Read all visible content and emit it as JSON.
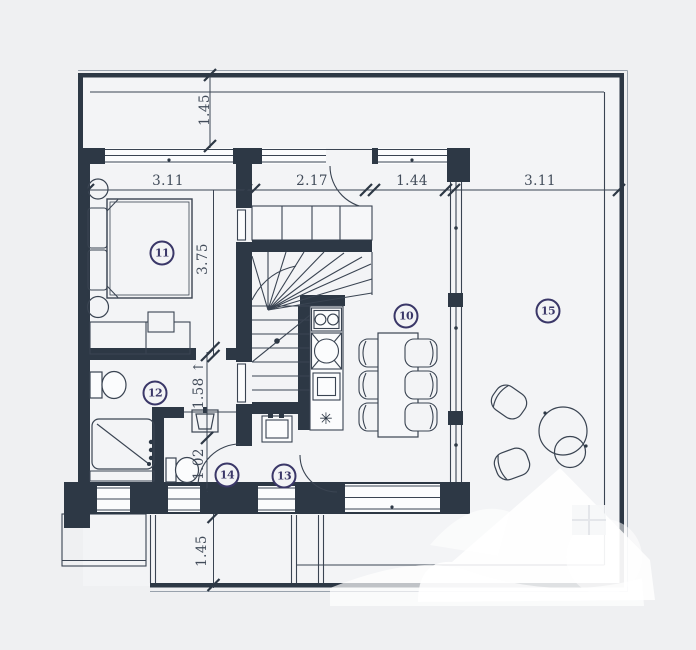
{
  "plan_title": "apartment-floor-plan",
  "colors": {
    "wall": "#2d3845",
    "thin_line": "#3a4452",
    "dim_text": "#414b59",
    "badge": "#3a3768",
    "background": "#eff0f2",
    "floor": "#f3f4f6",
    "watermark": "#ffffff"
  },
  "rooms": [
    {
      "label": "11"
    },
    {
      "label": "12"
    },
    {
      "label": "14"
    },
    {
      "label": "13"
    },
    {
      "label": "10"
    },
    {
      "label": "15"
    }
  ],
  "dimensions": [
    {
      "label": "1.45"
    },
    {
      "label": "3.11"
    },
    {
      "label": "2.17"
    },
    {
      "label": "1.44"
    },
    {
      "label": "3.11"
    },
    {
      "label": "3.75"
    },
    {
      "label": "1.58 ↑"
    },
    {
      "label": "1.02"
    },
    {
      "label": "1.45"
    }
  ],
  "kitchen": {
    "freezer_icon": "✳"
  }
}
